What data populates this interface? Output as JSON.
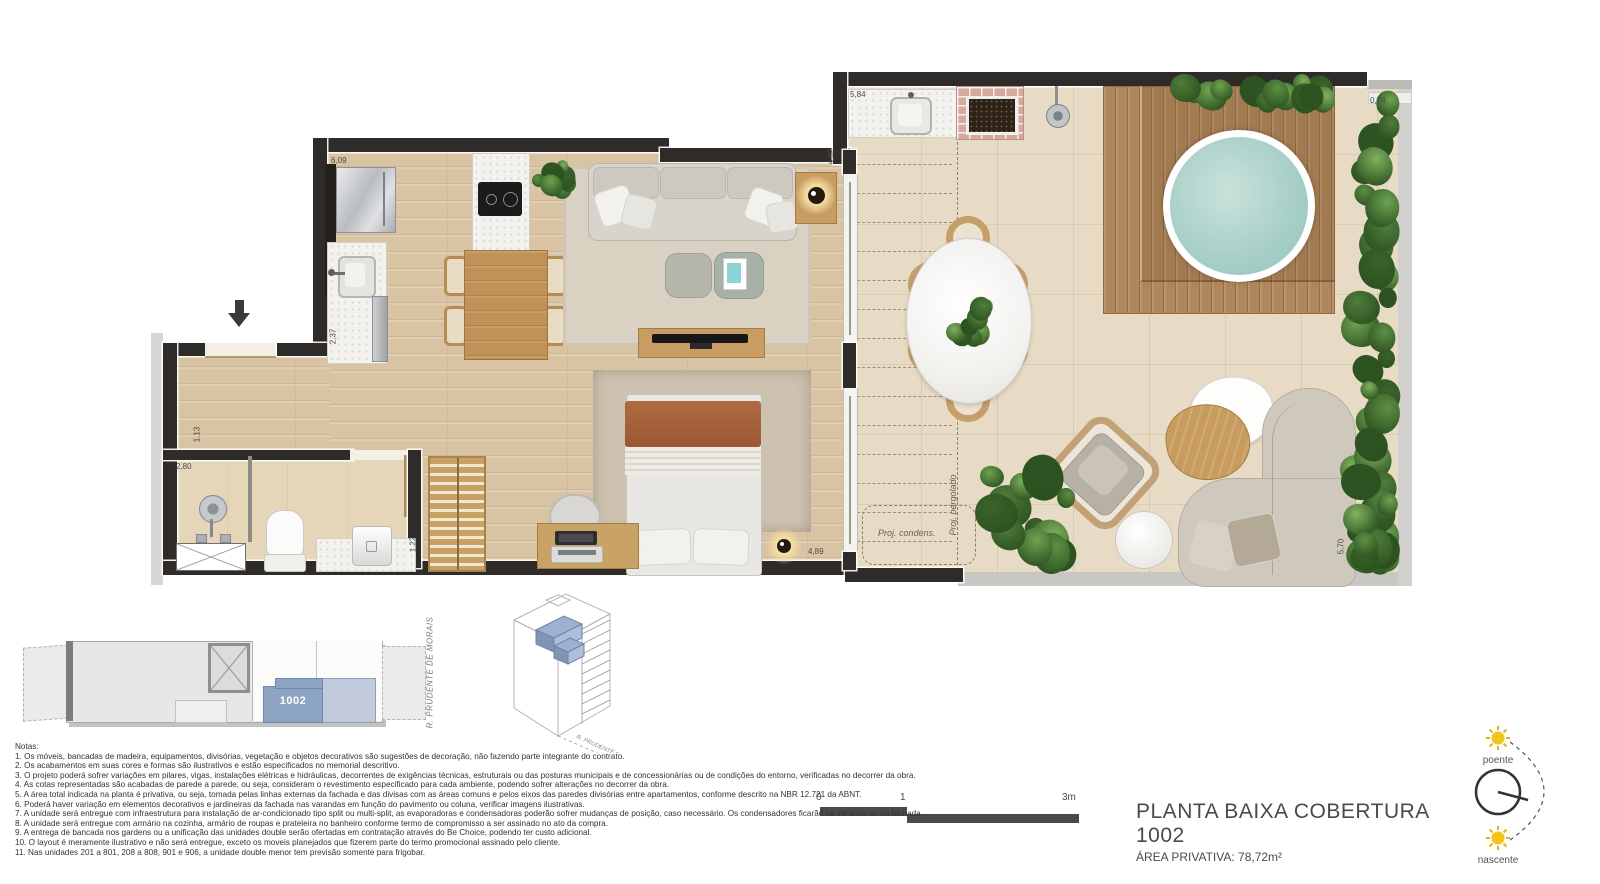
{
  "plan": {
    "title": "PLANTA BAIXA COBERTURA 1002",
    "subtitle": "ÁREA PRIVATIVA: 78,72m²",
    "unit_number": "1002",
    "street": "R. PRUDENTE DE MORAIS",
    "scale": {
      "t0": "0",
      "t1": "1",
      "t3": "3m"
    },
    "compass": {
      "top": "poente",
      "bottom": "nascente"
    },
    "labels": {
      "condens": "Proj. condens.",
      "pergolado": "Proj. pergolado"
    },
    "dimensions": {
      "kitchen_top": "6,09",
      "kitchen_counter": "2,37",
      "terrace_top": "5,84",
      "living_door": "4,92",
      "planter_top": "0,74",
      "hall": "1,13",
      "bath": "2,80",
      "bath_vanity": "1,22",
      "bedroom_door": "4,89",
      "terrace_side": "5,70"
    },
    "colors": {
      "wall": "#2e2b28",
      "unit_highlight": "#8da4c4",
      "unit_adjacent": "#c2cbdc",
      "pool_water": "#a9d0c8",
      "plant_green": "#4e7d3b",
      "sun_yellow": "#f0c419"
    }
  },
  "notes": {
    "heading": "Notas:",
    "items": [
      "1. Os móveis, bancadas de madeira, equipamentos, divisórias, vegetação e objetos decorativos são sugestões de decoração, não fazendo parte integrante do contrato.",
      "2. Os acabamentos em suas cores e formas são ilustrativos e estão especificados no memorial descritivo.",
      "3. O projeto poderá sofrer variações em pilares, vigas, instalações elétricas e hidráulicas, decorrentes de exigências técnicas, estruturais ou das posturas municipais e de concessionárias ou de condições do entorno, verificadas no decorrer da obra.",
      "4. As cotas representadas são acabadas de parede a parede, ou seja, consideram o revestimento especificado para cada ambiente, podendo sofrer alterações no decorrer da obra.",
      "5. A área total indicada na planta é privativa, ou seja, tomada pelas linhas externas da fachada e das divisas com as áreas comuns e pelos eixos das paredes divisórias entre apartamentos, conforme descrito na NBR 12.721 da ABNT.",
      "6. Poderá haver variação em elementos decorativos e jardineiras da fachada nas varandas em função do pavimento ou coluna, verificar imagens ilustrativas.",
      "7. A unidade será entregue com infraestrutura para instalação de ar-condicionado tipo split ou multi-split, as evaporadoras e condensadoras poderão sofrer mudanças de posição, caso necessário. Os condensadores ficarão na varanda ou na fachada.",
      "8. A unidade será entregue com armário na cozinha, armário de roupas e prateleira no banheiro conforme termo de compromisso a ser assinado no ato da compra.",
      "9. A entrega de bancada nos gardens ou a unificação das unidades double serão ofertadas em contratação através do Be Choice, podendo ter custo adicional.",
      "10. O layout é meramente ilustrativo e não será entregue, exceto os moveis planejados que fizerem parte do termo promocional assinado pelo cliente.",
      "11. Nas unidades 201 a 801, 208 a 808, 901 e 906, a unidade double menor tem previsão somente para frigobar."
    ]
  }
}
